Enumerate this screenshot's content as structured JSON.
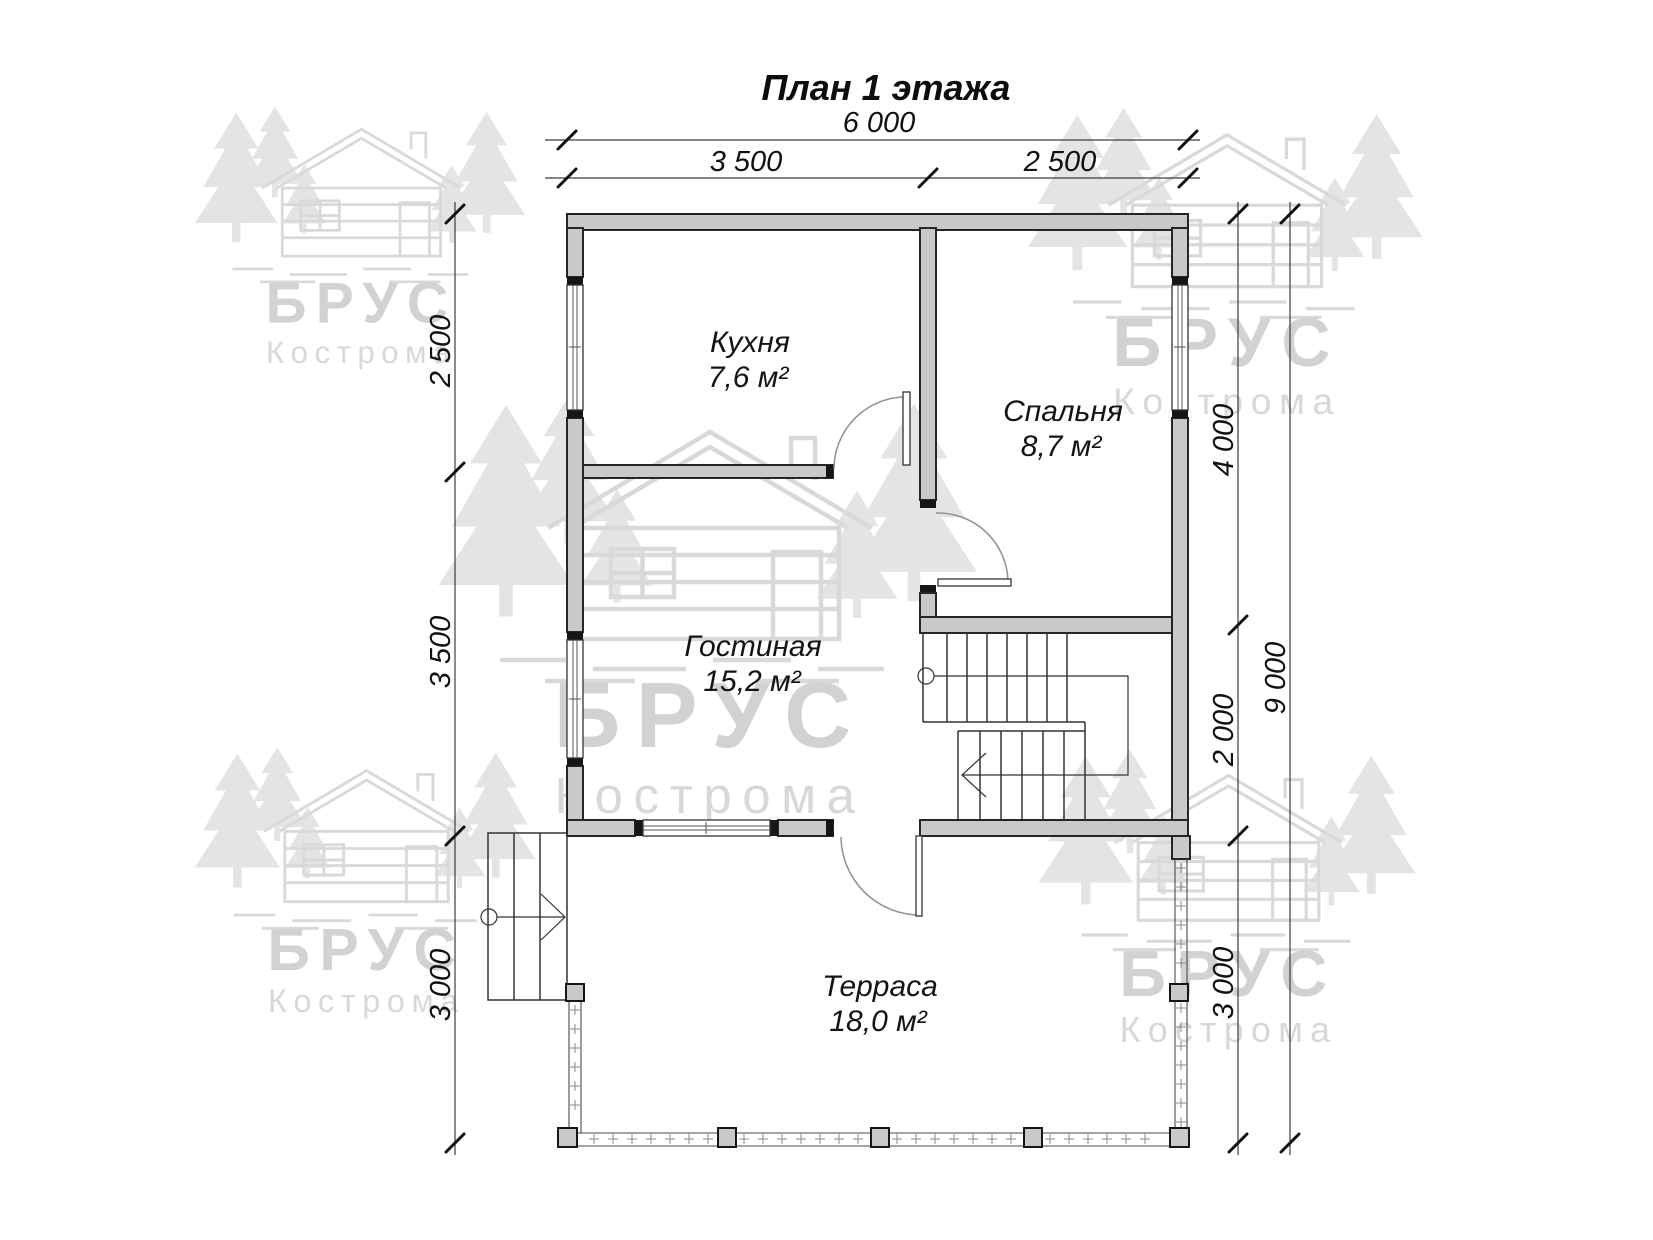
{
  "title": "План 1 этажа",
  "watermark": {
    "brand": "БРУС",
    "city": "Кострома"
  },
  "rooms": [
    {
      "name": "Кухня",
      "area": "7,6 м²"
    },
    {
      "name": "Спальня",
      "area": "8,7 м²"
    },
    {
      "name": "Гостиная",
      "area": "15,2 м²"
    },
    {
      "name": "Терраса",
      "area": "18,0 м²"
    }
  ],
  "dimensions": {
    "top_overall": "6 000",
    "top_left": "3 500",
    "top_right": "2 500",
    "left_top": "2 500",
    "left_mid": "3 500",
    "left_bottom": "3 000",
    "right_top": "4 000",
    "right_mid": "2 000",
    "right_bottom": "3 000",
    "right_overall": "9 000"
  },
  "colors": {
    "wall_fill": "#c9c9c9",
    "line": "#262626",
    "watermark": "#d4d4d4"
  }
}
